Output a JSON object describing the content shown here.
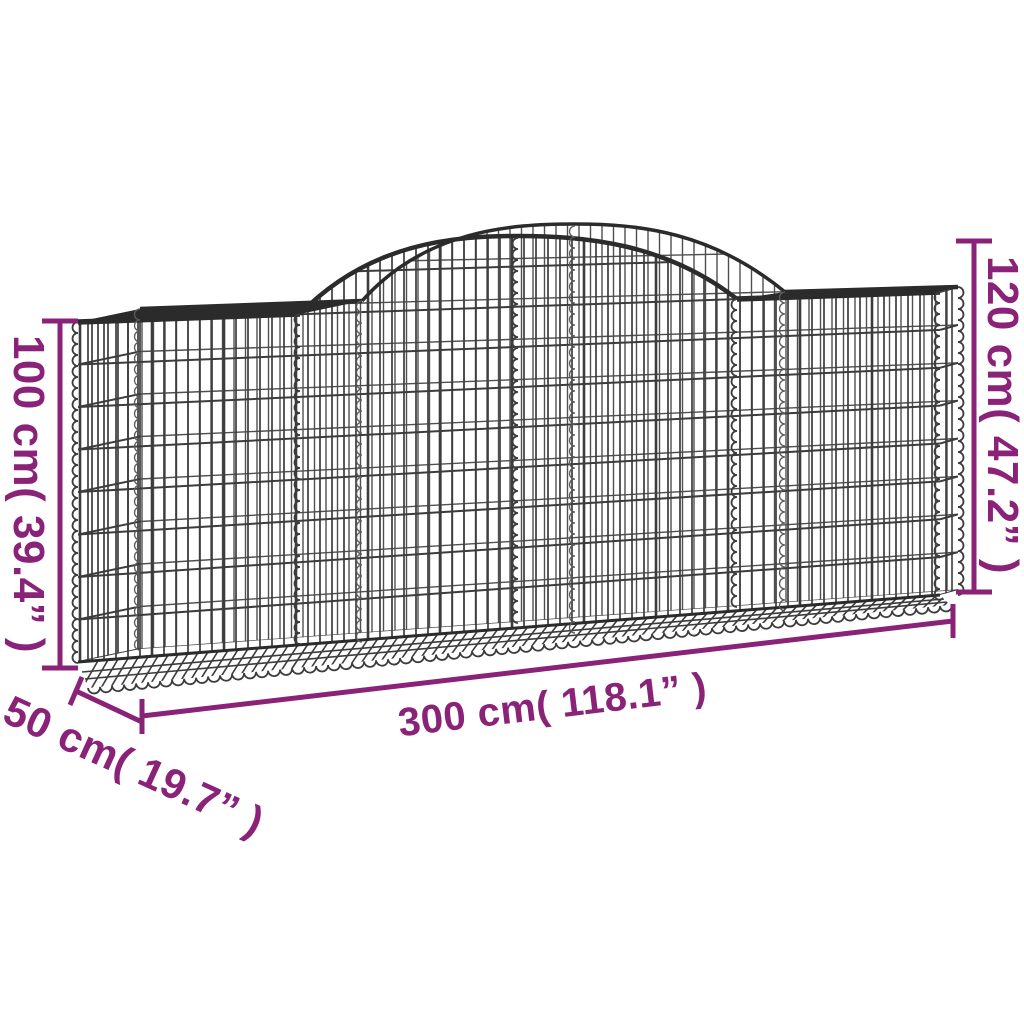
{
  "diagram": {
    "subject": "arched gabion basket wireframe",
    "dimensions": {
      "left_height": "100 cm( 39.4” )",
      "right_height": "120 cm( 47.2” )",
      "bottom_width": "300 cm( 118.1” )",
      "front_depth": "50 cm( 19.7” )"
    },
    "colors": {
      "dimension": "#8A2278",
      "wire": "#3C3C3C",
      "wire_back": "#4F4F4F",
      "wire_dark": "#2B2B2B",
      "background": "#FFFFFF"
    }
  }
}
